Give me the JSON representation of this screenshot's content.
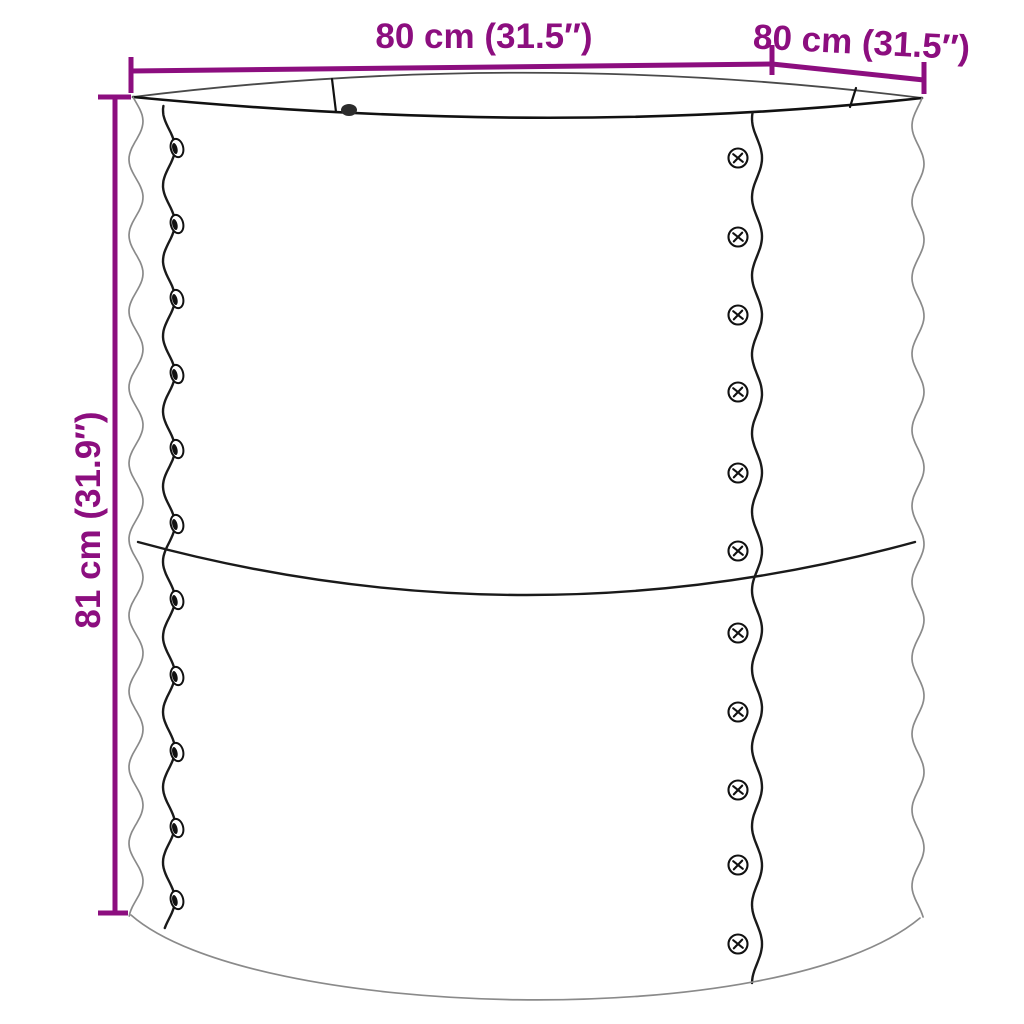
{
  "diagram": {
    "subject": "round corrugated metal raised garden planter with dimension annotations",
    "accent_color": "#8C0E7F",
    "line_color": "#1a1a1a"
  },
  "dimensions": {
    "width_label": "80 cm (31.5″)",
    "depth_label": "80 cm (31.5″)",
    "height_label": "81 cm (31.9″)"
  },
  "drawing": {
    "left_rivets": {
      "x": 177,
      "ys": [
        148,
        224,
        299,
        374,
        449,
        524,
        600,
        676,
        752,
        828,
        900
      ]
    },
    "right_rivets": {
      "x": 738,
      "ys": [
        158,
        237,
        315,
        392,
        473,
        551,
        633,
        712,
        790,
        865,
        944
      ]
    },
    "waves": {
      "left-outer": {
        "cx": 136,
        "amp": 7,
        "period": 76,
        "yref": 97,
        "p0": -0.44,
        "y0": 97,
        "y1": 916
      },
      "right-outer": {
        "cx": 918,
        "amp": 6,
        "period": 76,
        "yref": 98,
        "p0": 2.41,
        "y0": 98,
        "y1": 918
      },
      "left-seam": {
        "cx": 169,
        "amp": 6,
        "period": 75.2,
        "yref": 148,
        "p0": 1.571,
        "y0": 106,
        "y1": 930
      },
      "right-seam": {
        "cx": 757,
        "amp": 5,
        "period": 78.6,
        "yref": 158,
        "p0": 1.571,
        "y0": 113,
        "y1": 984
      }
    }
  }
}
